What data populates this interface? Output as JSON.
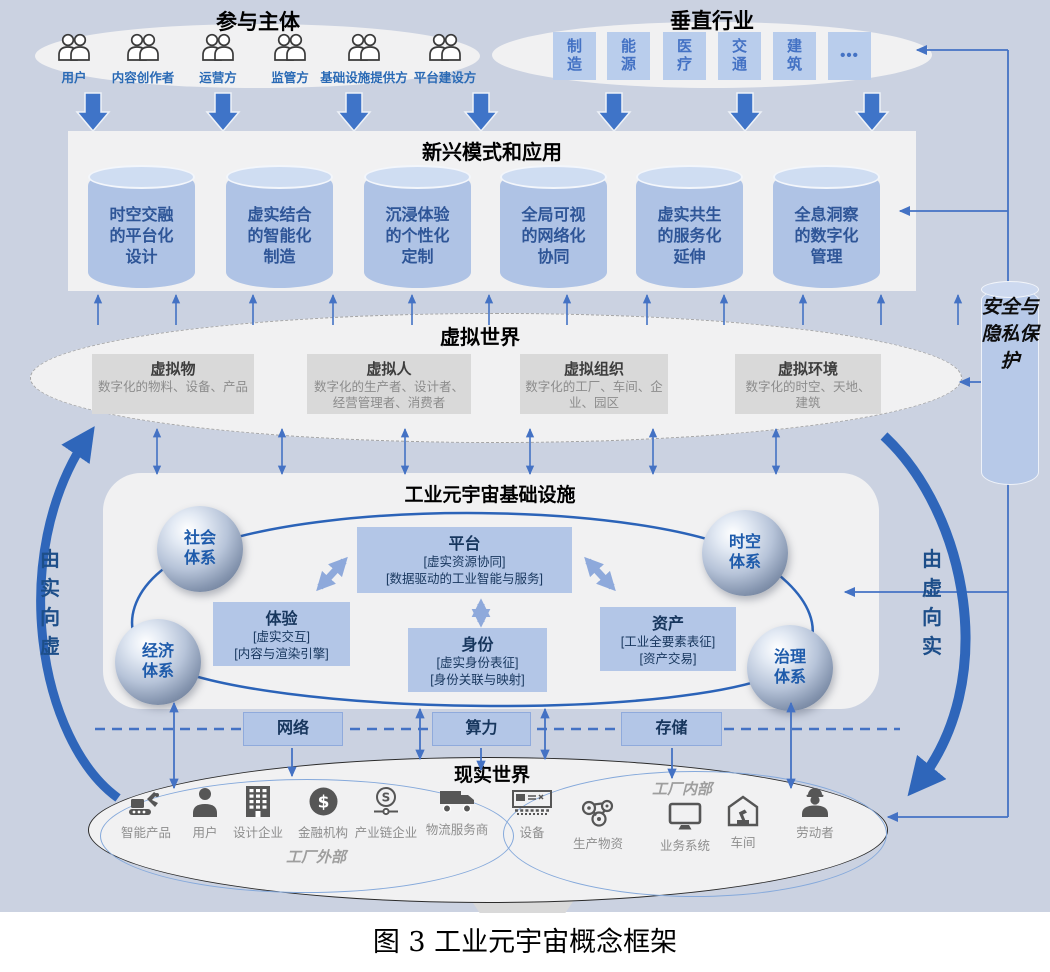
{
  "participants": {
    "title": "参与主体",
    "items": [
      {
        "icon": "people-icon",
        "label": "用户"
      },
      {
        "icon": "people-icon",
        "label": "内容创作者"
      },
      {
        "icon": "people-icon",
        "label": "运营方"
      },
      {
        "icon": "people-icon",
        "label": "监管方"
      },
      {
        "icon": "people-icon",
        "label": "基础设施提供方"
      },
      {
        "icon": "people-icon",
        "label": "平台建设方"
      }
    ]
  },
  "industries": {
    "title": "垂直行业",
    "items": [
      {
        "label": "制\n造"
      },
      {
        "label": "能\n源"
      },
      {
        "label": "医\n疗"
      },
      {
        "label": "交\n通"
      },
      {
        "label": "建\n筑"
      },
      {
        "label": "•••"
      }
    ]
  },
  "applications": {
    "title": "新兴模式和应用",
    "items": [
      {
        "label": "时空交融\n的平台化\n设计"
      },
      {
        "label": "虚实结合\n的智能化\n制造"
      },
      {
        "label": "沉浸体验\n的个性化\n定制"
      },
      {
        "label": "全局可视\n的网络化\n协同"
      },
      {
        "label": "虚实共生\n的服务化\n延伸"
      },
      {
        "label": "全息洞察\n的数字化\n管理"
      }
    ]
  },
  "virtual_world": {
    "title": "虚拟世界",
    "items": [
      {
        "title": "虚拟物",
        "desc": "数字化的物料、设备、产品"
      },
      {
        "title": "虚拟人",
        "desc": "数字化的生产者、设计者、经营管理者、消费者"
      },
      {
        "title": "虚拟组织",
        "desc": "数字化的工厂、车间、企业、园区"
      },
      {
        "title": "虚拟环境",
        "desc": "数字化的时空、天地、建筑"
      }
    ]
  },
  "infrastructure": {
    "title": "工业元宇宙基础设施",
    "spheres": [
      {
        "label": "社会\n体系"
      },
      {
        "label": "时空\n体系"
      },
      {
        "label": "经济\n体系"
      },
      {
        "label": "治理\n体系"
      }
    ],
    "modules": [
      {
        "title": "平台",
        "desc": "[虚实资源协同]\n[数据驱动的工业智能与服务]"
      },
      {
        "title": "体验",
        "desc": "[虚实交互]\n[内容与渲染引擎]"
      },
      {
        "title": "身份",
        "desc": "[虚实身份表征]\n[身份关联与映射]"
      },
      {
        "title": "资产",
        "desc": "[工业全要素表征]\n[资产交易]"
      }
    ],
    "resources": [
      {
        "label": "网络"
      },
      {
        "label": "算力"
      },
      {
        "label": "存储"
      }
    ]
  },
  "real_world": {
    "title": "现实世界",
    "factory_outside": {
      "label": "工厂外部",
      "items": [
        {
          "icon": "excavator-icon",
          "label": "智能产品"
        },
        {
          "icon": "person-icon",
          "label": "用户"
        },
        {
          "icon": "building-icon",
          "label": "设计企业"
        },
        {
          "icon": "coin-icon",
          "label": "金融机构"
        },
        {
          "icon": "chain-icon",
          "label": "产业链企业"
        },
        {
          "icon": "truck-icon",
          "label": "物流服务商"
        }
      ]
    },
    "factory_inside": {
      "label": "工厂内部",
      "items": [
        {
          "icon": "machine-icon",
          "label": "设备"
        },
        {
          "icon": "gears-icon",
          "label": "生产物资"
        },
        {
          "icon": "monitor-icon",
          "label": "业务系统"
        },
        {
          "icon": "workshop-icon",
          "label": "车间"
        },
        {
          "icon": "worker-icon",
          "label": "劳动者"
        }
      ]
    }
  },
  "security": {
    "label": "安全与隐私保护"
  },
  "flows": {
    "left": "由实向虚",
    "right": "由虚向实"
  },
  "caption": "图 3 工业元宇宙概念框架",
  "colors": {
    "background": "#cbd2e1",
    "panel": "#f1f1f2",
    "box_blue": "#b3c6e7",
    "arrow_blue": "#4472c4",
    "thick_arrow_blue": "#2f66ba",
    "navy_text": "#17365d",
    "gray_box": "#d9d9d9"
  }
}
